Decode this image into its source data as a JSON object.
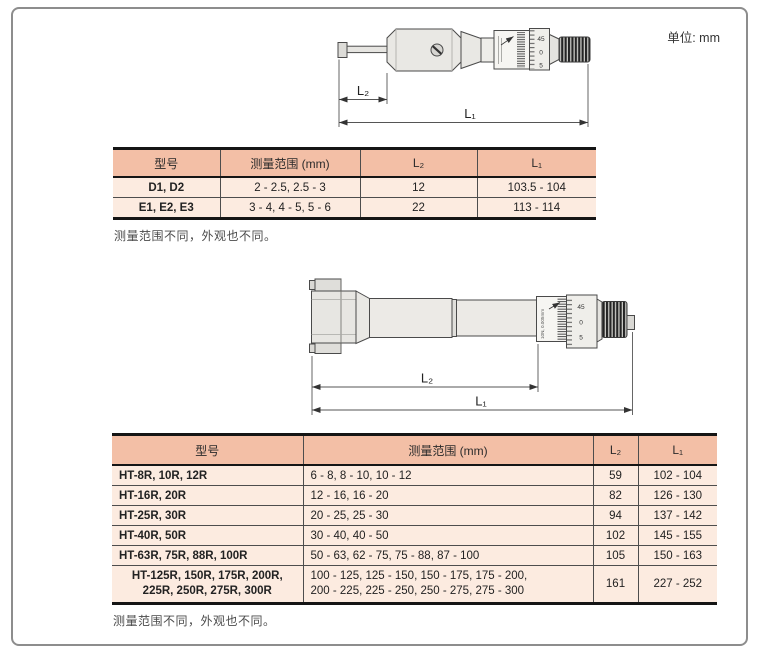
{
  "page": {
    "unit_label": "单位: mm"
  },
  "diagram1": {
    "label_l2": "L₂",
    "label_l1": "L₁",
    "thimble_scale": [
      "45",
      "0",
      "5"
    ]
  },
  "diagram2": {
    "label_l2": "L₂",
    "label_l1": "L₁",
    "thimble_scale": [
      "45",
      "0",
      "5"
    ],
    "sleeve_marking": "10N, 0.005mm"
  },
  "table1": {
    "headers": {
      "model": "型号",
      "range": "测量范围 (mm)",
      "l2": "L₂",
      "l1": "L₁"
    },
    "rows": [
      {
        "model": "D1, D2",
        "range": "2 - 2.5, 2.5 - 3",
        "l2": "12",
        "l1": "103.5 - 104"
      },
      {
        "model": "E1, E2, E3",
        "range": "3 - 4, 4 - 5, 5 - 6",
        "l2": "22",
        "l1": "113 - 114"
      }
    ],
    "note": "测量范围不同，外观也不同。"
  },
  "table2": {
    "headers": {
      "model": "型号",
      "range": "测量范围 (mm)",
      "l2": "L₂",
      "l1": "L₁"
    },
    "rows": [
      {
        "model": "HT-8R, 10R, 12R",
        "range": "6 - 8, 8 - 10, 10 - 12",
        "l2": "59",
        "l1": "102 - 104"
      },
      {
        "model": "HT-16R, 20R",
        "range": "12 - 16, 16 - 20",
        "l2": "82",
        "l1": "126 - 130"
      },
      {
        "model": "HT-25R, 30R",
        "range": "20 - 25, 25 - 30",
        "l2": "94",
        "l1": "137 - 142"
      },
      {
        "model": "HT-40R, 50R",
        "range": "30 - 40, 40 - 50",
        "l2": "102",
        "l1": "145 - 155"
      },
      {
        "model": "HT-63R, 75R, 88R, 100R",
        "range": "50 - 63, 62 - 75, 75 - 88, 87 - 100",
        "l2": "105",
        "l1": "150 - 163"
      },
      {
        "model": "HT-125R, 150R, 175R, 200R,\n225R, 250R, 275R, 300R",
        "range": "100 - 125, 125 - 150, 150 - 175, 175 - 200,\n200 - 225, 225 - 250, 250 - 275, 275 - 300",
        "l2": "161",
        "l1": "227 - 252"
      }
    ],
    "note": "测量范围不同，外观也不同。"
  },
  "colors": {
    "table_header_bg": "#f3bfa6",
    "table_row_bg": "#fcebe0",
    "rule_dark": "#151515",
    "frame_border": "#8d8d8d"
  }
}
